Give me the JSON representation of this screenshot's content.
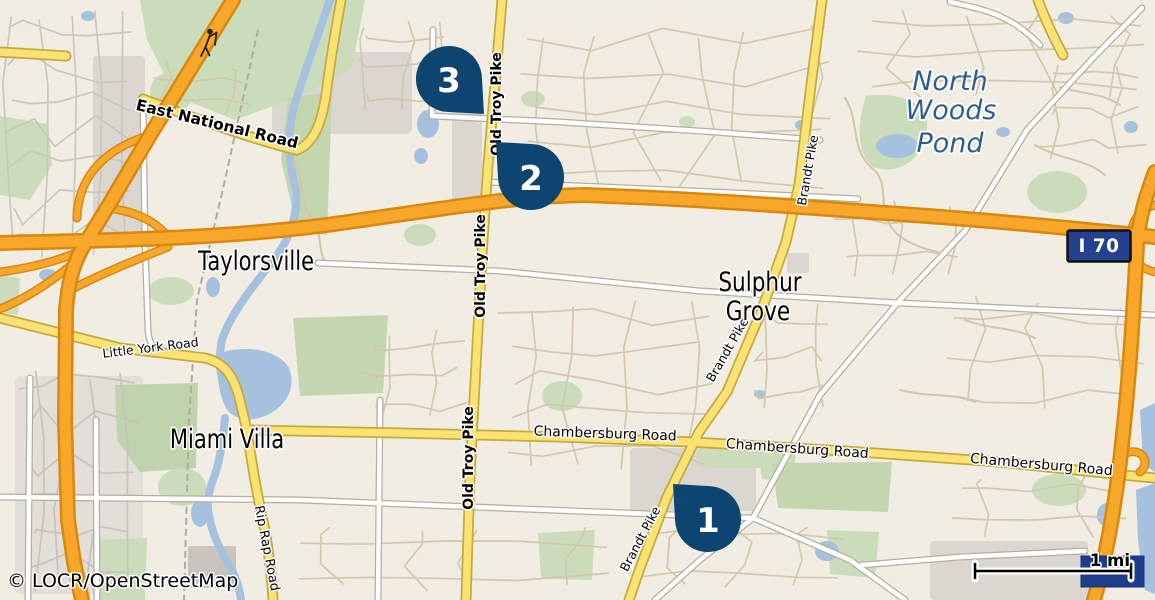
{
  "attribution": "© LOCR/OpenStreetMap",
  "scale": {
    "label": "1 mi"
  },
  "highway_shield": {
    "label": "I 70"
  },
  "pins": [
    {
      "number": "1"
    },
    {
      "number": "2"
    },
    {
      "number": "3"
    }
  ],
  "places": {
    "taylorsville": "Taylorsville",
    "sulphur_grove_line1": "Sulphur",
    "sulphur_grove_line2": "Grove",
    "miami_villa": "Miami Villa"
  },
  "water_label": {
    "line1": "North",
    "line2": "Woods",
    "line3": "Pond"
  },
  "roads": {
    "east_national": "East National Road",
    "old_troy": "Old Troy Pike",
    "brandt": "Brandt Pike",
    "little_york": "Little York Road",
    "chambersburg": "Chambersburg Road",
    "rip_rap": "Rip Rap Road"
  },
  "colors": {
    "background": "#f1ede3",
    "water": "#a6c1de",
    "green": "#cbdcba",
    "highway_orange": "#f8a72b",
    "road_yellow": "#fce173",
    "pin_blue": "#0e4570",
    "shield_blue": "#23418e",
    "logo_box_blue": "#1c3c8c"
  }
}
